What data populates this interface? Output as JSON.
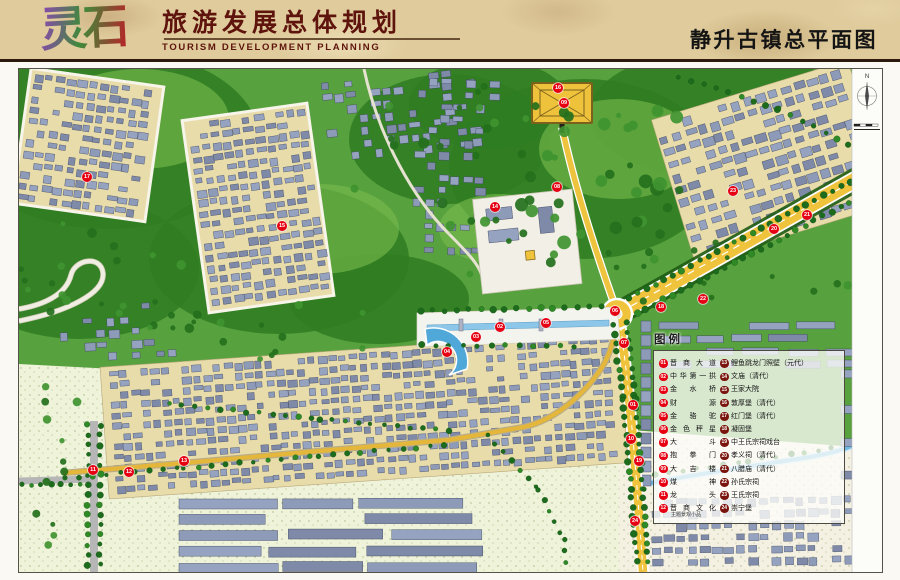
{
  "header": {
    "logo": "灵石",
    "title_cn": "旅游发展总体规划",
    "title_en": "TOURISM DEVELOPMENT PLANNING",
    "page_title": "静升古镇总平面图"
  },
  "compass": {
    "label": "N"
  },
  "legend": {
    "title": "图例",
    "items": [
      {
        "n": "01",
        "label": "晋商大道"
      },
      {
        "n": "02",
        "label": "中华第一拱"
      },
      {
        "n": "03",
        "label": "金水桥"
      },
      {
        "n": "04",
        "label": "财源"
      },
      {
        "n": "05",
        "label": "金骆驼"
      },
      {
        "n": "06",
        "label": "金色秤星"
      },
      {
        "n": "07",
        "label": "大斗"
      },
      {
        "n": "08",
        "label": "抱拳门"
      },
      {
        "n": "09",
        "label": "大吉楼"
      },
      {
        "n": "10",
        "label": "煤神"
      },
      {
        "n": "11",
        "label": "龙头"
      },
      {
        "n": "12",
        "label": "晋商文化",
        "note": "主题景观小品"
      },
      {
        "n": "13",
        "label": "鲤鱼跳龙门照壁（元代）"
      },
      {
        "n": "14",
        "label": "文庙（清代）"
      },
      {
        "n": "15",
        "label": "王家大院"
      },
      {
        "n": "16",
        "label": "敦厚堡（清代）"
      },
      {
        "n": "17",
        "label": "红门堡（清代）"
      },
      {
        "n": "18",
        "label": "凝固堡"
      },
      {
        "n": "19",
        "label": "中王氏宗祠戏台"
      },
      {
        "n": "20",
        "label": "孝义祠（清代）"
      },
      {
        "n": "21",
        "label": "八腊庙（清代）"
      },
      {
        "n": "22",
        "label": "孙氏宗祠"
      },
      {
        "n": "23",
        "label": "王氏宗祠"
      },
      {
        "n": "24",
        "label": "崇宁堡"
      }
    ]
  },
  "map": {
    "markers": [
      {
        "n": "01",
        "x": 614,
        "y": 336
      },
      {
        "n": "02",
        "x": 481,
        "y": 258
      },
      {
        "n": "03",
        "x": 457,
        "y": 268
      },
      {
        "n": "04",
        "x": 428,
        "y": 283
      },
      {
        "n": "05",
        "x": 527,
        "y": 254
      },
      {
        "n": "06",
        "x": 596,
        "y": 242
      },
      {
        "n": "07",
        "x": 605,
        "y": 274
      },
      {
        "n": "08",
        "x": 538,
        "y": 118
      },
      {
        "n": "09",
        "x": 545,
        "y": 34
      },
      {
        "n": "10",
        "x": 612,
        "y": 370
      },
      {
        "n": "11",
        "x": 74,
        "y": 401
      },
      {
        "n": "12",
        "x": 110,
        "y": 403
      },
      {
        "n": "13",
        "x": 165,
        "y": 392
      },
      {
        "n": "14",
        "x": 476,
        "y": 138
      },
      {
        "n": "15",
        "x": 263,
        "y": 157
      },
      {
        "n": "16",
        "x": 539,
        "y": 19
      },
      {
        "n": "17",
        "x": 68,
        "y": 108
      },
      {
        "n": "18",
        "x": 642,
        "y": 238
      },
      {
        "n": "19",
        "x": 620,
        "y": 392
      },
      {
        "n": "20",
        "x": 755,
        "y": 160
      },
      {
        "n": "21",
        "x": 788,
        "y": 146
      },
      {
        "n": "22",
        "x": 684,
        "y": 230
      },
      {
        "n": "23",
        "x": 714,
        "y": 122
      },
      {
        "n": "24",
        "x": 616,
        "y": 452
      }
    ]
  },
  "colors": {
    "marker_red": "#e60012",
    "legend_dark": "#7a150d",
    "road_yellow": "#f0c33c",
    "water": "#6fb9e2",
    "roof": "#8d9ab8",
    "ground_tan": "#e8dcab",
    "green_dark": "#2f7d22",
    "green_mid": "#57a13e",
    "field_pale": "#eef3da",
    "header_text": "#5e140d"
  }
}
